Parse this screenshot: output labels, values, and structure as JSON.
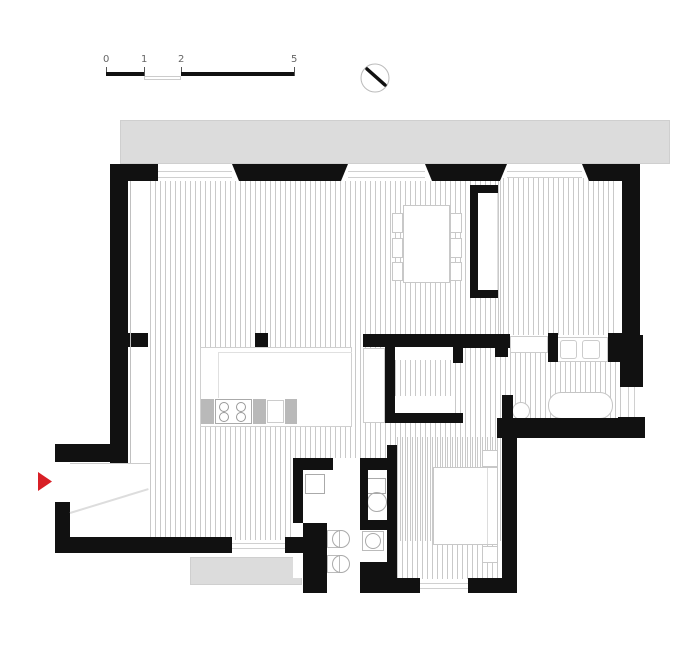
{
  "title": "apartment-floor-plan",
  "colors": {
    "wall": "#111111",
    "balcony": "#dcdcdc",
    "balcony_edge": "#cfcfcf",
    "hatch": "#c9c9c9",
    "furniture_outline": "#c5c5c5",
    "entry_arrow_red": "#d81f26",
    "background": "#ffffff"
  },
  "scale_bar": {
    "labels": [
      "0",
      "1",
      "2",
      "5"
    ],
    "unit": "meters"
  },
  "north_indicator": {
    "icon": "compass-circle-with-needle"
  },
  "plan": {
    "elements": [
      {
        "name": "balcony-top",
        "x": 120,
        "y": 120,
        "w": 550,
        "h": 44,
        "fill": "#dcdcdc",
        "stroke": "#cfcfcf"
      },
      {
        "name": "balcony-bottom",
        "x": 190,
        "y": 557,
        "w": 112,
        "h": 28,
        "fill": "#dcdcdc",
        "stroke": "#cfcfcf"
      },
      {
        "name": "floor-living-kitchen",
        "x": 150,
        "y": 181,
        "w": 352,
        "h": 360,
        "fill": "hatch"
      },
      {
        "name": "floor-bedroom-top-right",
        "x": 498,
        "y": 178,
        "w": 119,
        "h": 157,
        "fill": "hatch"
      },
      {
        "name": "floor-bathroom",
        "x": 505,
        "y": 352,
        "w": 117,
        "h": 68,
        "fill": "hatch"
      },
      {
        "name": "floor-bedroom-bottom-right",
        "x": 397,
        "y": 437,
        "w": 105,
        "h": 142,
        "fill": "hatch"
      },
      {
        "name": "floor-closet-passage",
        "x": 395,
        "y": 358,
        "w": 68,
        "h": 42,
        "fill": "hatch"
      },
      {
        "name": "utility-block-interior",
        "x": 293,
        "y": 458,
        "w": 104,
        "h": 120,
        "fill": "#ffffff"
      },
      {
        "name": "closet-shelf-top",
        "x": 395,
        "y": 347,
        "w": 58,
        "h": 13,
        "fill": "#ffffff"
      },
      {
        "name": "closet-shelf-bottom",
        "x": 395,
        "y": 396,
        "w": 58,
        "h": 17,
        "fill": "#ffffff"
      },
      {
        "name": "wardrobe-recess-interior",
        "x": 472,
        "y": 188,
        "w": 26,
        "h": 107,
        "fill": "#ffffff",
        "stroke": "#e0e0e0"
      },
      {
        "name": "dining-table",
        "x": 403,
        "y": 205,
        "w": 47,
        "h": 78,
        "fill": "#ffffff",
        "stroke": "#c8c8c8"
      },
      {
        "name": "dining-chair",
        "x": 392,
        "y": 213,
        "w": 11,
        "h": 20,
        "fill": "#ffffff",
        "stroke": "#c8c8c8"
      },
      {
        "name": "dining-chair",
        "x": 392,
        "y": 238,
        "w": 11,
        "h": 20,
        "fill": "#ffffff",
        "stroke": "#c8c8c8"
      },
      {
        "name": "dining-chair",
        "x": 392,
        "y": 262,
        "w": 11,
        "h": 19,
        "fill": "#ffffff",
        "stroke": "#c8c8c8"
      },
      {
        "name": "dining-chair",
        "x": 450,
        "y": 213,
        "w": 12,
        "h": 20,
        "fill": "#ffffff",
        "stroke": "#c8c8c8"
      },
      {
        "name": "dining-chair",
        "x": 450,
        "y": 238,
        "w": 12,
        "h": 20,
        "fill": "#ffffff",
        "stroke": "#c8c8c8"
      },
      {
        "name": "dining-chair",
        "x": 450,
        "y": 262,
        "w": 12,
        "h": 19,
        "fill": "#ffffff",
        "stroke": "#c8c8c8"
      },
      {
        "name": "kitchen-island",
        "x": 200,
        "y": 347,
        "w": 152,
        "h": 80,
        "fill": "#ffffff",
        "stroke": "#d0d0d0"
      },
      {
        "name": "kitchen-island-counter-line-h",
        "x": 218,
        "y": 352,
        "w": 134,
        "h": 1,
        "fill": "#e0e0e0"
      },
      {
        "name": "kitchen-island-counter-line-v",
        "x": 218,
        "y": 352,
        "w": 1,
        "h": 46,
        "fill": "#e0e0e0"
      },
      {
        "name": "kitchen-cabinet",
        "x": 201,
        "y": 399,
        "w": 13,
        "h": 25,
        "fill": "#b9b9b9"
      },
      {
        "name": "kitchen-stove",
        "x": 215,
        "y": 399,
        "w": 37,
        "h": 25,
        "fill": "#ffffff",
        "stroke": "#aaaaaa"
      },
      {
        "name": "stove-burner",
        "x": 219,
        "y": 402,
        "w": 10,
        "h": 10,
        "stroke": "#999999",
        "rad": "50%"
      },
      {
        "name": "stove-burner",
        "x": 219,
        "y": 412,
        "w": 10,
        "h": 10,
        "stroke": "#999999",
        "rad": "50%"
      },
      {
        "name": "stove-burner",
        "x": 236,
        "y": 402,
        "w": 10,
        "h": 10,
        "stroke": "#999999",
        "rad": "50%"
      },
      {
        "name": "stove-burner",
        "x": 236,
        "y": 412,
        "w": 10,
        "h": 10,
        "stroke": "#999999",
        "rad": "50%"
      },
      {
        "name": "kitchen-cabinet",
        "x": 253,
        "y": 399,
        "w": 13,
        "h": 25,
        "fill": "#b9b9b9"
      },
      {
        "name": "kitchen-sink",
        "x": 267,
        "y": 400,
        "w": 17,
        "h": 23,
        "fill": "#ffffff",
        "stroke": "#cccccc"
      },
      {
        "name": "kitchen-cabinet",
        "x": 285,
        "y": 399,
        "w": 12,
        "h": 25,
        "fill": "#b9b9b9"
      },
      {
        "name": "bed",
        "x": 433,
        "y": 467,
        "w": 65,
        "h": 78,
        "fill": "#ffffff",
        "stroke": "#c8c8c8"
      },
      {
        "name": "bed-pillow-line",
        "x": 487,
        "y": 468,
        "w": 1,
        "h": 76,
        "fill": "#dddddd"
      },
      {
        "name": "nightstand",
        "x": 482,
        "y": 450,
        "w": 16,
        "h": 17,
        "fill": "#ffffff",
        "stroke": "#c8c8c8"
      },
      {
        "name": "nightstand",
        "x": 482,
        "y": 546,
        "w": 16,
        "h": 17,
        "fill": "#ffffff",
        "stroke": "#c8c8c8"
      },
      {
        "name": "bathtub",
        "x": 548,
        "y": 392,
        "w": 65,
        "h": 27,
        "fill": "#ffffff",
        "stroke": "#c5c5c5",
        "rad": "13px"
      },
      {
        "name": "bathroom-sink-round",
        "x": 512,
        "y": 402,
        "w": 18,
        "h": 18,
        "fill": "#ffffff",
        "stroke": "#c5c5c5",
        "rad": "50%"
      },
      {
        "name": "bathroom-vanity",
        "x": 556,
        "y": 337,
        "w": 52,
        "h": 25,
        "fill": "#ffffff",
        "stroke": "#cccccc"
      },
      {
        "name": "vanity-basin",
        "x": 560,
        "y": 340,
        "w": 17,
        "h": 19,
        "stroke": "#cccccc",
        "rad": "3px"
      },
      {
        "name": "vanity-basin",
        "x": 582,
        "y": 340,
        "w": 18,
        "h": 19,
        "stroke": "#cccccc",
        "rad": "3px"
      },
      {
        "name": "bathroom-niche",
        "x": 510,
        "y": 336,
        "w": 38,
        "h": 17,
        "fill": "#ffffff",
        "stroke": "#cccccc"
      },
      {
        "name": "closet-wardrobe-strip",
        "x": 363,
        "y": 348,
        "w": 22,
        "h": 75,
        "fill": "#ffffff",
        "stroke": "#cccccc"
      },
      {
        "name": "washing-machine",
        "x": 305,
        "y": 474,
        "w": 20,
        "h": 20,
        "fill": "#ffffff",
        "stroke": "#aaaaaa"
      },
      {
        "name": "laundry-unit-back",
        "x": 327,
        "y": 530,
        "w": 13,
        "h": 18,
        "fill": "#ffffff",
        "stroke": "#bbbbbb"
      },
      {
        "name": "laundry-unit-drum",
        "x": 332,
        "y": 530,
        "w": 18,
        "h": 18,
        "stroke": "#aaaaaa",
        "rad": "50%"
      },
      {
        "name": "laundry-unit-back",
        "x": 327,
        "y": 555,
        "w": 13,
        "h": 18,
        "fill": "#ffffff",
        "stroke": "#bbbbbb"
      },
      {
        "name": "laundry-unit-drum",
        "x": 332,
        "y": 555,
        "w": 18,
        "h": 18,
        "stroke": "#aaaaaa",
        "rad": "50%"
      },
      {
        "name": "toilet-tank",
        "x": 366,
        "y": 478,
        "w": 20,
        "h": 16,
        "fill": "#ffffff",
        "stroke": "#aaaaaa"
      },
      {
        "name": "toilet-bowl",
        "x": 367,
        "y": 492,
        "w": 20,
        "h": 20,
        "stroke": "#aaaaaa",
        "rad": "50%"
      },
      {
        "name": "wc-sink-back",
        "x": 362,
        "y": 531,
        "w": 22,
        "h": 20,
        "fill": "#ffffff",
        "stroke": "#bbbbbb"
      },
      {
        "name": "wc-sink-bowl",
        "x": 365,
        "y": 533,
        "w": 16,
        "h": 16,
        "stroke": "#aaaaaa",
        "rad": "50%"
      },
      {
        "name": "wall-top-1",
        "x": 110,
        "y": 164,
        "w": 48,
        "h": 17,
        "fill": "#111111"
      },
      {
        "name": "wall-top-2",
        "x": 232,
        "y": 164,
        "w": 116,
        "h": 17,
        "fill": "#111111",
        "clip": "polygon(0 0, 100% 0, calc(100% - 7px) 100%, 7px 100%)"
      },
      {
        "name": "wall-top-3",
        "x": 425,
        "y": 164,
        "w": 82,
        "h": 17,
        "fill": "#111111",
        "clip": "polygon(0 0, 100% 0, calc(100% - 7px) 100%, 7px 100%)"
      },
      {
        "name": "wall-top-4",
        "x": 582,
        "y": 164,
        "w": 58,
        "h": 17,
        "fill": "#111111",
        "clip": "polygon(0 0, 100% 0, 100% 100%, 7px 100%)"
      },
      {
        "name": "wall-left",
        "x": 110,
        "y": 164,
        "w": 18,
        "h": 299,
        "fill": "#111111"
      },
      {
        "name": "wall-left-stub",
        "x": 128,
        "y": 333,
        "w": 20,
        "h": 14,
        "fill": "#111111"
      },
      {
        "name": "kitchen-column",
        "x": 255,
        "y": 333,
        "w": 13,
        "h": 14,
        "fill": "#111111"
      },
      {
        "name": "wall-right-upper",
        "x": 622,
        "y": 164,
        "w": 18,
        "h": 171,
        "fill": "#111111"
      },
      {
        "name": "wall-right-bath",
        "x": 620,
        "y": 335,
        "w": 23,
        "h": 52,
        "fill": "#111111"
      },
      {
        "name": "wall-right-corner",
        "x": 618,
        "y": 417,
        "w": 27,
        "h": 21,
        "fill": "#111111"
      },
      {
        "name": "wall-entry-upper",
        "x": 55,
        "y": 444,
        "w": 73,
        "h": 18,
        "fill": "#111111"
      },
      {
        "name": "wall-entry-lower",
        "x": 55,
        "y": 502,
        "w": 15,
        "h": 48,
        "fill": "#111111"
      },
      {
        "name": "wall-bottom-1",
        "x": 55,
        "y": 537,
        "w": 177,
        "h": 16,
        "fill": "#111111"
      },
      {
        "name": "wall-bottom-2",
        "x": 285,
        "y": 537,
        "w": 18,
        "h": 16,
        "fill": "#111111"
      },
      {
        "name": "wall-closet-top",
        "x": 363,
        "y": 334,
        "w": 100,
        "h": 13,
        "fill": "#111111"
      },
      {
        "name": "wall-closet-left",
        "x": 385,
        "y": 334,
        "w": 10,
        "h": 89,
        "fill": "#111111"
      },
      {
        "name": "wall-closet-bottom",
        "x": 385,
        "y": 413,
        "w": 78,
        "h": 10,
        "fill": "#111111"
      },
      {
        "name": "wall-closet-stub",
        "x": 453,
        "y": 334,
        "w": 10,
        "h": 29,
        "fill": "#111111"
      },
      {
        "name": "wall-bath-top-left",
        "x": 460,
        "y": 334,
        "w": 50,
        "h": 14,
        "fill": "#111111"
      },
      {
        "name": "wall-bath-stub",
        "x": 495,
        "y": 334,
        "w": 13,
        "h": 23,
        "fill": "#111111"
      },
      {
        "name": "wall-bath-mid",
        "x": 548,
        "y": 333,
        "w": 10,
        "h": 29,
        "fill": "#111111"
      },
      {
        "name": "wall-bath-right",
        "x": 608,
        "y": 333,
        "w": 14,
        "h": 29,
        "fill": "#111111"
      },
      {
        "name": "wall-bath-left-lower",
        "x": 502,
        "y": 395,
        "w": 11,
        "h": 42,
        "fill": "#111111"
      },
      {
        "name": "wall-horizontal-low",
        "x": 497,
        "y": 418,
        "w": 148,
        "h": 20,
        "fill": "#111111"
      },
      {
        "name": "wall-bedroom2-right",
        "x": 502,
        "y": 437,
        "w": 15,
        "h": 156,
        "fill": "#111111"
      },
      {
        "name": "wall-bottom-3",
        "x": 397,
        "y": 578,
        "w": 23,
        "h": 15,
        "fill": "#111111"
      },
      {
        "name": "wall-bottom-4",
        "x": 468,
        "y": 578,
        "w": 49,
        "h": 15,
        "fill": "#111111"
      },
      {
        "name": "wall-block-top-left",
        "x": 293,
        "y": 458,
        "w": 40,
        "h": 12,
        "fill": "#111111"
      },
      {
        "name": "wall-block-top-right",
        "x": 360,
        "y": 458,
        "w": 27,
        "h": 12,
        "fill": "#111111"
      },
      {
        "name": "wall-block-left",
        "x": 293,
        "y": 458,
        "w": 10,
        "h": 65,
        "fill": "#111111"
      },
      {
        "name": "wall-block-chunk",
        "x": 303,
        "y": 523,
        "w": 24,
        "h": 70,
        "fill": "#111111"
      },
      {
        "name": "wall-block-divider-v",
        "x": 360,
        "y": 467,
        "w": 8,
        "h": 63,
        "fill": "#111111"
      },
      {
        "name": "wall-block-divider-h",
        "x": 360,
        "y": 520,
        "w": 27,
        "h": 10,
        "fill": "#111111"
      },
      {
        "name": "wall-block-bottom-right",
        "x": 360,
        "y": 562,
        "w": 37,
        "h": 31,
        "fill": "#111111"
      },
      {
        "name": "wall-block-right",
        "x": 387,
        "y": 445,
        "w": 10,
        "h": 120,
        "fill": "#111111"
      },
      {
        "name": "wall-wardrobe-top",
        "x": 470,
        "y": 185,
        "w": 28,
        "h": 8,
        "fill": "#111111"
      },
      {
        "name": "wall-wardrobe-left",
        "x": 470,
        "y": 185,
        "w": 8,
        "h": 113,
        "fill": "#111111"
      },
      {
        "name": "wall-wardrobe-bottom",
        "x": 470,
        "y": 290,
        "w": 28,
        "h": 8,
        "fill": "#111111"
      },
      {
        "name": "window-glazing-line",
        "x": 158,
        "y": 171,
        "w": 74,
        "h": 1,
        "fill": "#d0d0d0"
      },
      {
        "name": "window-glazing-line",
        "x": 158,
        "y": 177,
        "w": 74,
        "h": 1,
        "fill": "#d0d0d0"
      },
      {
        "name": "window-glazing-line",
        "x": 348,
        "y": 171,
        "w": 77,
        "h": 1,
        "fill": "#d0d0d0"
      },
      {
        "name": "window-glazing-line",
        "x": 348,
        "y": 177,
        "w": 77,
        "h": 1,
        "fill": "#d0d0d0"
      },
      {
        "name": "window-glazing-line",
        "x": 507,
        "y": 171,
        "w": 75,
        "h": 1,
        "fill": "#d0d0d0"
      },
      {
        "name": "window-glazing-line",
        "x": 507,
        "y": 177,
        "w": 75,
        "h": 1,
        "fill": "#d0d0d0"
      },
      {
        "name": "window-right",
        "x": 622,
        "y": 387,
        "w": 21,
        "h": 30,
        "fill": "#ffffff"
      },
      {
        "name": "window-glazing-line",
        "x": 628,
        "y": 387,
        "w": 1,
        "h": 30,
        "fill": "#d0d0d0"
      },
      {
        "name": "window-glazing-line",
        "x": 634,
        "y": 387,
        "w": 1,
        "h": 30,
        "fill": "#d0d0d0"
      },
      {
        "name": "window-bottom-1",
        "x": 232,
        "y": 540,
        "w": 53,
        "h": 12,
        "fill": "#ffffff"
      },
      {
        "name": "window-glazing-line",
        "x": 232,
        "y": 543,
        "w": 53,
        "h": 1,
        "fill": "#d0d0d0"
      },
      {
        "name": "window-glazing-line",
        "x": 232,
        "y": 548,
        "w": 53,
        "h": 1,
        "fill": "#d0d0d0"
      },
      {
        "name": "window-bottom-2",
        "x": 420,
        "y": 580,
        "w": 48,
        "h": 12,
        "fill": "#ffffff"
      },
      {
        "name": "window-glazing-line",
        "x": 420,
        "y": 583,
        "w": 48,
        "h": 1,
        "fill": "#d0d0d0"
      },
      {
        "name": "window-glazing-line",
        "x": 420,
        "y": 588,
        "w": 48,
        "h": 1,
        "fill": "#d0d0d0"
      },
      {
        "name": "wall-face-line",
        "x": 130,
        "y": 181,
        "w": 1,
        "h": 282,
        "fill": "#c0c0c0"
      },
      {
        "name": "entry-corridor-line",
        "x": 70,
        "y": 463,
        "w": 80,
        "h": 1,
        "fill": "#cccccc"
      },
      {
        "name": "entry-door-swing",
        "x": 70,
        "y": 512,
        "w": 82,
        "h": 2,
        "fill": "#dddddd",
        "rot": -17
      },
      {
        "name": "entrance-arrow",
        "x": 38,
        "y": 472,
        "w": 14,
        "h": 19,
        "fill": "#d81f26",
        "clip": "polygon(0 0, 100% 50%, 0 100%)"
      }
    ]
  }
}
